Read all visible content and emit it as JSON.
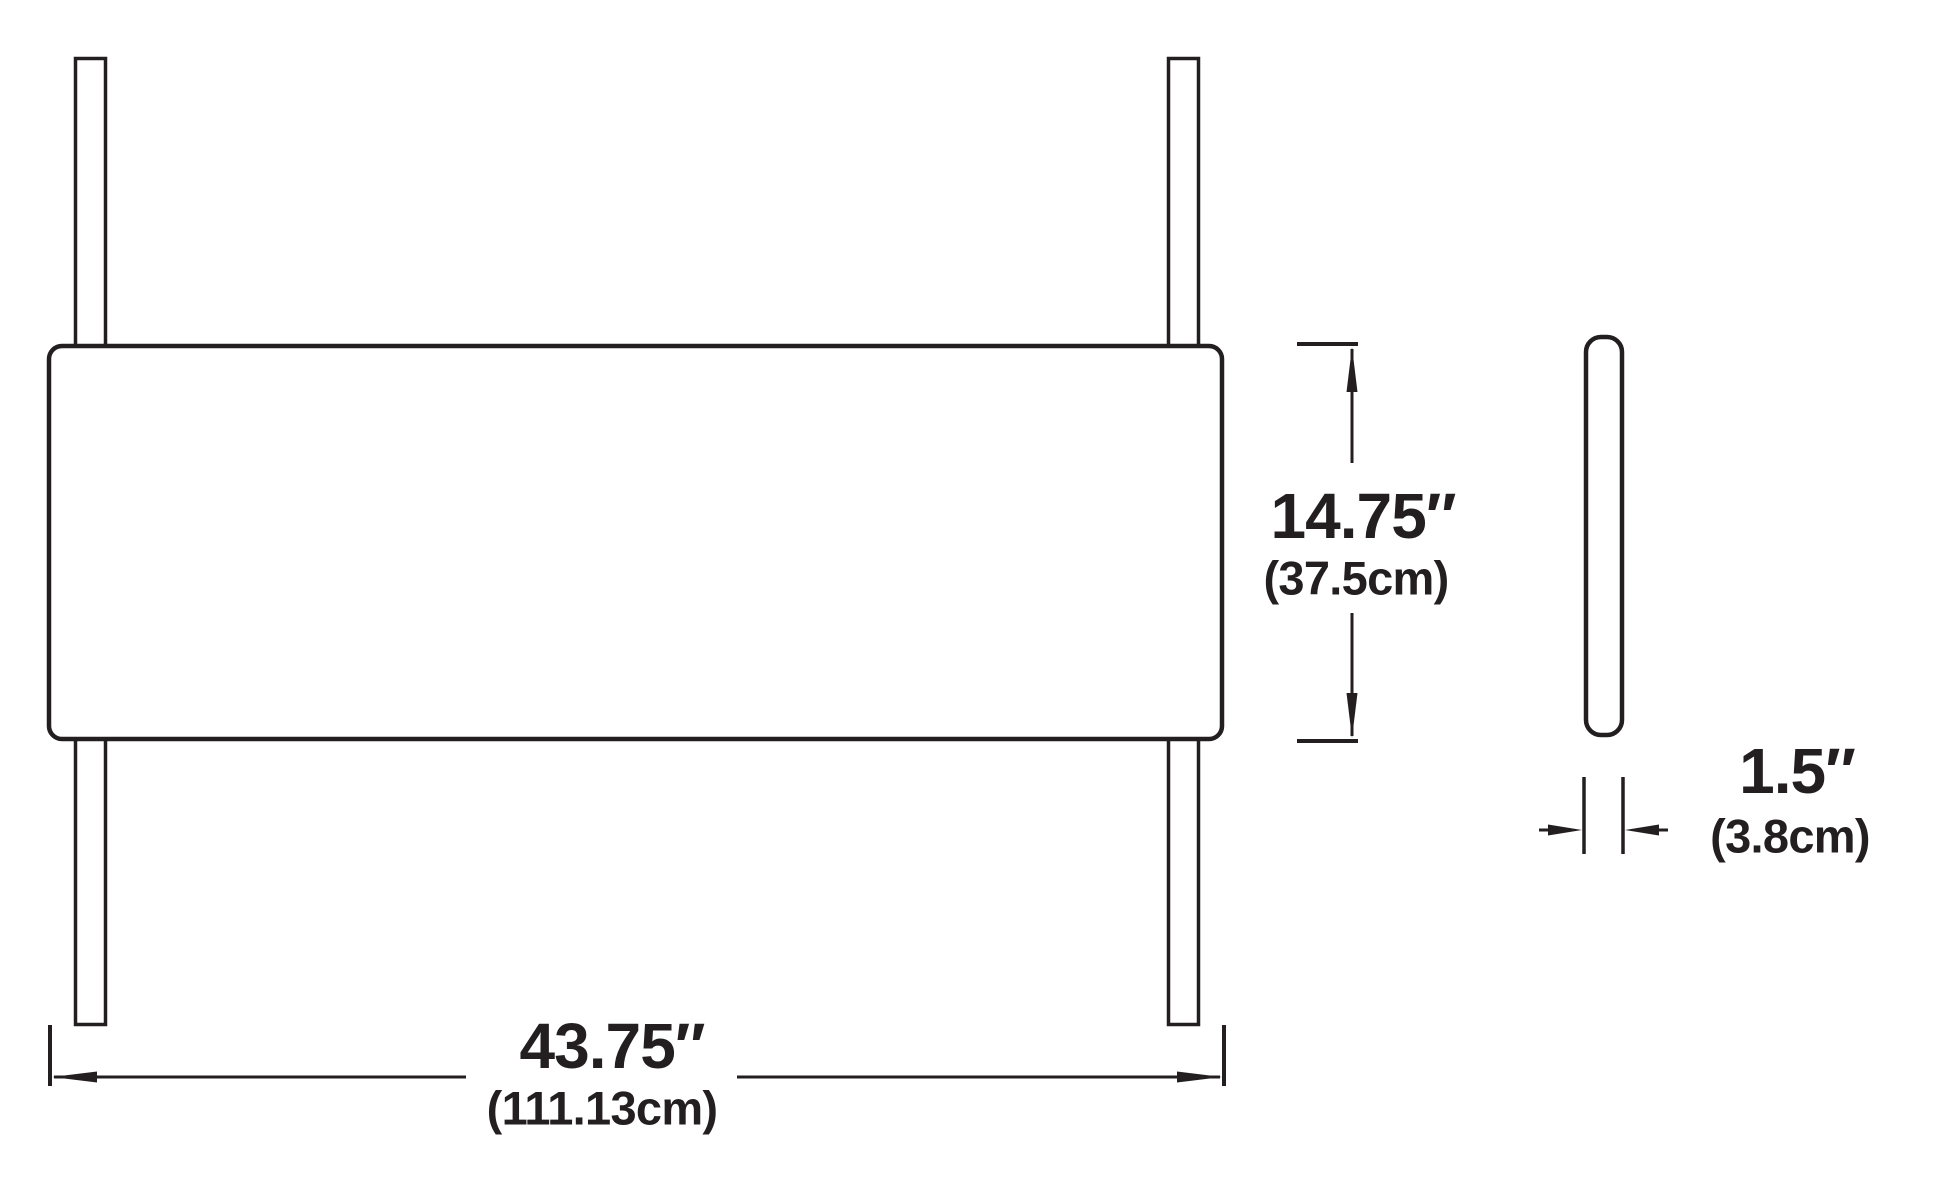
{
  "dimensions": {
    "height": {
      "inches": "14.75″",
      "metric": "(37.5cm)"
    },
    "width": {
      "inches": "43.75″",
      "metric": "(111.13cm)"
    },
    "thickness": {
      "inches": "1.5″",
      "metric": "(3.8cm)"
    }
  },
  "colors": {
    "line": "#231f20",
    "background": "#ffffff"
  }
}
